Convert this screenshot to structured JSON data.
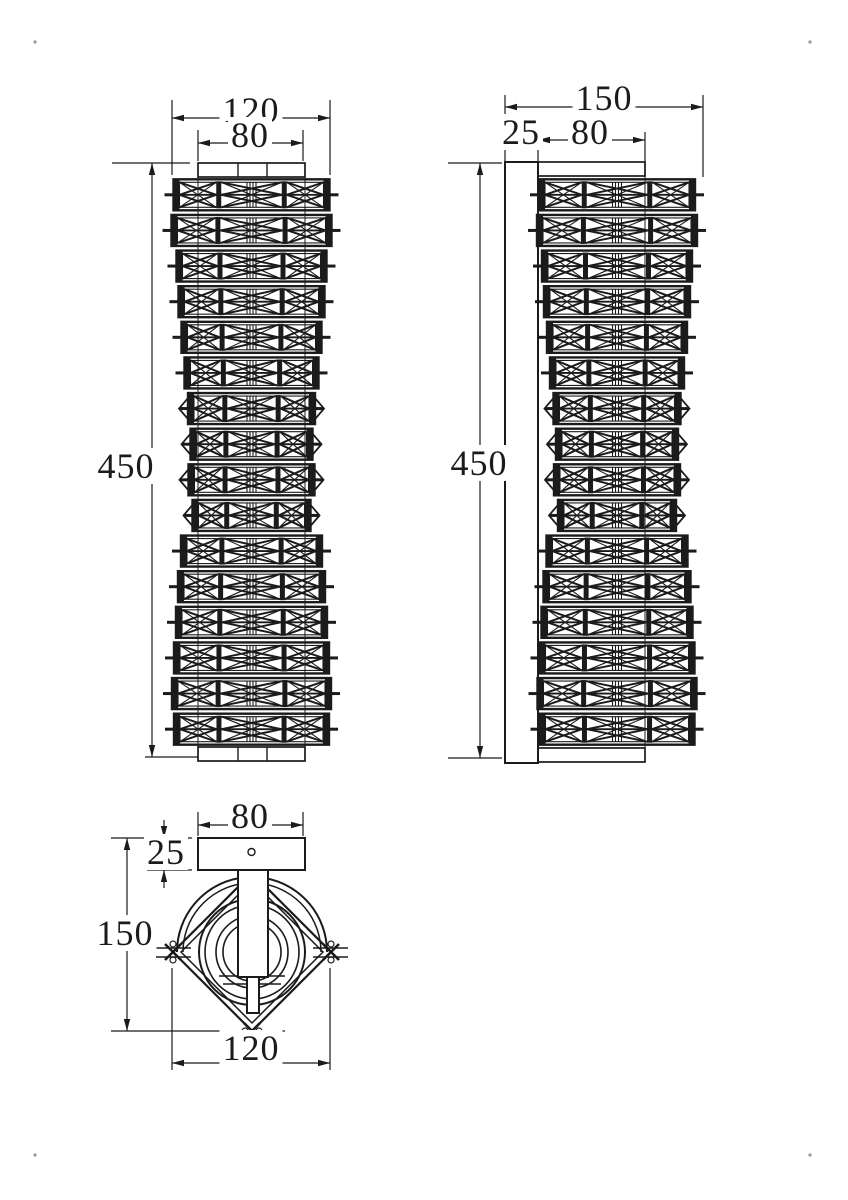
{
  "page": {
    "bg": "#ffffff",
    "ink": "#1b1b1b",
    "corner_dot": "#979797"
  },
  "views": {
    "front": {
      "label": "Front view",
      "dimensions": {
        "outer_width": "120",
        "inner_width": "80",
        "height": "450"
      }
    },
    "side": {
      "label": "Side view",
      "dimensions": {
        "total_depth": "150",
        "wall_plate_depth": "25",
        "bracket_depth": "80",
        "height": "450"
      }
    },
    "top": {
      "label": "Top view",
      "dimensions": {
        "plate_width": "80",
        "plate_depth": "25",
        "total_depth": "150",
        "outer_width": "120"
      }
    }
  },
  "drawing": {
    "segment_count": 16,
    "segment_widths": [
      156,
      160,
      150,
      146,
      140,
      134,
      127,
      122,
      126,
      118,
      141,
      147,
      151,
      155,
      159,
      155
    ],
    "pointed_segments": [
      6,
      7,
      8,
      9
    ],
    "front_center_x": 251.5,
    "side_center_x": 617,
    "body_top": 177,
    "body_bottom": 747
  }
}
